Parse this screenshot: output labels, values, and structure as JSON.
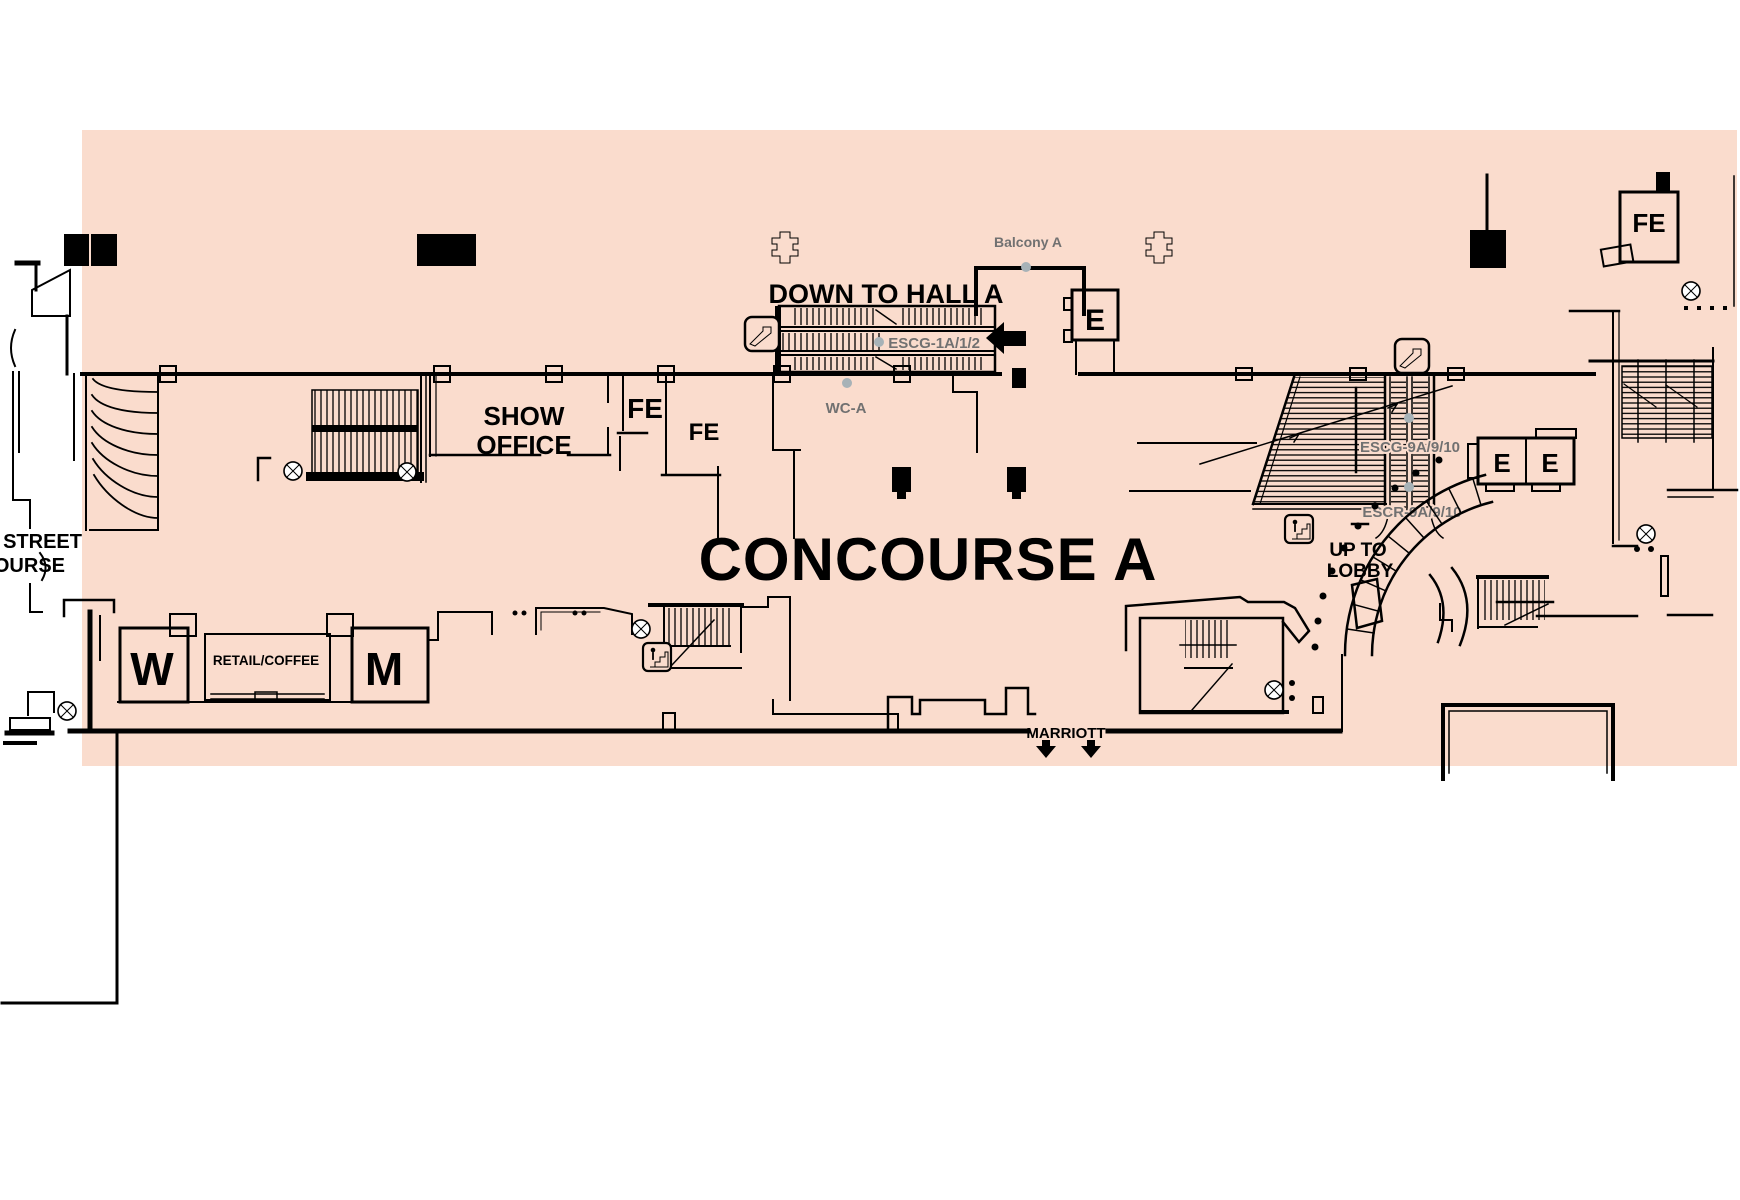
{
  "page": {
    "title": "CONCOURSE A"
  },
  "colors": {
    "floor_fill": "#fadccd",
    "wall": "#000000",
    "gray_label": "#717171",
    "gray_dot": "#a7b2b7",
    "page_bg": "#ffffff"
  },
  "labels": {
    "down_to_hall": "DOWN TO HALL A",
    "balcony_a": "Balcony A",
    "escalator_group_1": "ESCG-1A/1/2",
    "wc_a": "WC-A",
    "show_office_line1": "SHOW",
    "show_office_line2": "OFFICE",
    "fire_extinguisher": "FE",
    "elevator": "E",
    "escalator_group_9": "ESCG-9A/9/10",
    "escalator_return_9": "ESCR-9A/9/10",
    "up_to_lobby_line1": "UP TO",
    "up_to_lobby_line2": "LOBBY",
    "street_edge": "STREET",
    "concourse_edge": "OURSE",
    "womens_restroom": "W",
    "mens_restroom": "M",
    "retail_coffee": "RETAIL/COFFEE",
    "marriott_exit": "MARRIOTT"
  },
  "icons": {
    "escalator": "escalator-icon",
    "stairs": "stairs-icon",
    "survey_marker": "quadrant-circle-icon",
    "structural_column": "cross-column-icon",
    "left_arrow": "left-arrow-icon",
    "down_arrow": "down-arrow-icon"
  }
}
